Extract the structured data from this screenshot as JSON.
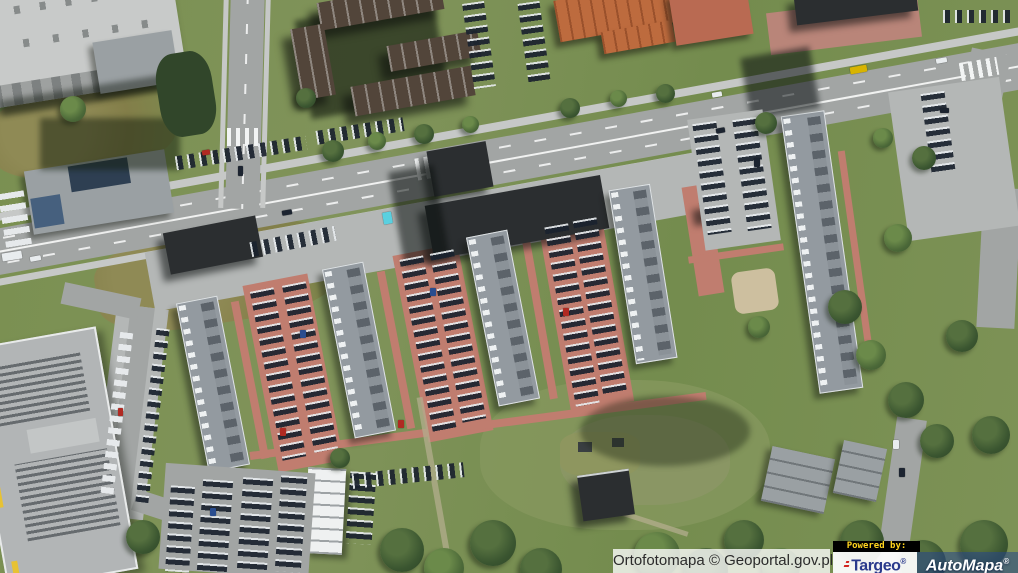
{
  "attribution": {
    "source_label": "Ortofotomapa © Geoportal.gov.pl",
    "powered_by_label": "Powered by:",
    "targeo": {
      "name": "Targeo",
      "reg": "®",
      "brand_color": "#2a3a8c",
      "mark_color": "#d2241e"
    },
    "automapa": {
      "name": "AutoMapa",
      "reg": "®",
      "brand_color": "#26468a"
    }
  },
  "map": {
    "type": "orthophoto-aerial",
    "colors": {
      "grass": "#7a9051",
      "road": "#a2a5a4",
      "apartment_roof": "#939aa0",
      "commercial_roof": "#2b2e30",
      "brick_path": "#c07d6f",
      "orange_roof": "#bd6b3e",
      "brown_roof": "#52453a",
      "tree": "#3a5530"
    },
    "features": [
      "main-avenue",
      "side-street",
      "residential-slab-blocks",
      "retail-pavilions",
      "industrial-hall",
      "housing-estate-parking",
      "green-field",
      "playground",
      "tree-rows",
      "event-tent",
      "garages"
    ]
  }
}
